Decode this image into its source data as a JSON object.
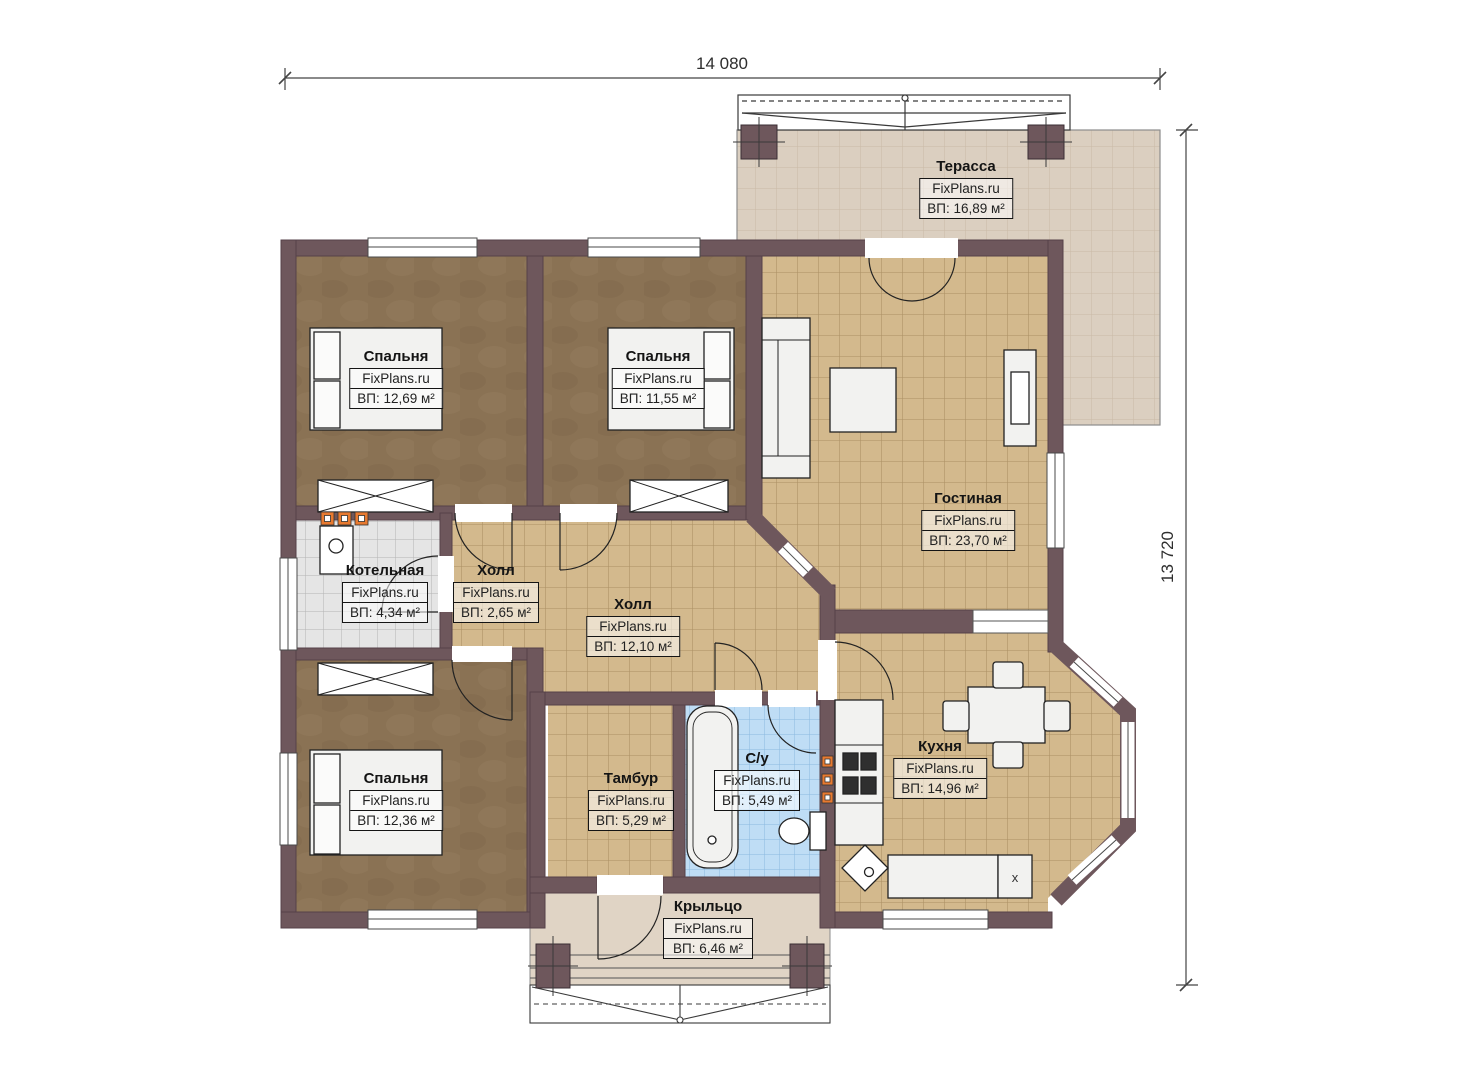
{
  "watermark": "FixPlans.ru",
  "dimensions": {
    "top": "14 080",
    "right": "13 720"
  },
  "rooms": {
    "terrace": {
      "name": "Терасса",
      "area": "ВП: 16,89 м²"
    },
    "bedroom_top_left": {
      "name": "Спальня",
      "area": "ВП: 12,69 м²"
    },
    "bedroom_top_middle": {
      "name": "Спальня",
      "area": "ВП: 11,55 м²"
    },
    "living_room": {
      "name": "Гостиная",
      "area": "ВП: 23,70 м²"
    },
    "boiler_room": {
      "name": "Котельная",
      "area": "ВП: 4,34 м²"
    },
    "hall_small": {
      "name": "Холл",
      "area": "ВП: 2,65 м²"
    },
    "hall": {
      "name": "Холл",
      "area": "ВП: 12,10 м²"
    },
    "bedroom_bottom_left": {
      "name": "Спальня",
      "area": "ВП: 12,36 м²"
    },
    "vestibule": {
      "name": "Тамбур",
      "area": "ВП: 5,29 м²"
    },
    "bathroom": {
      "name": "С/у",
      "area": "ВП: 5,49 м²"
    },
    "kitchen": {
      "name": "Кухня",
      "area": "ВП: 14,96 м²"
    },
    "porch": {
      "name": "Крыльцо",
      "area": "ВП: 6,46 м²"
    }
  },
  "annotations": {
    "kitchen_counter_mark": "x"
  },
  "colors": {
    "wall": "#6e575c",
    "tile": "#d3b98d",
    "wood": "#8a7254",
    "bathtile": "#bfddf5",
    "boilertile": "#e5e5e5",
    "terrace": "#dbcfc0",
    "porch": "#e0d4c5",
    "accent": "#e87a30",
    "furniture": "#f2f2f0"
  }
}
